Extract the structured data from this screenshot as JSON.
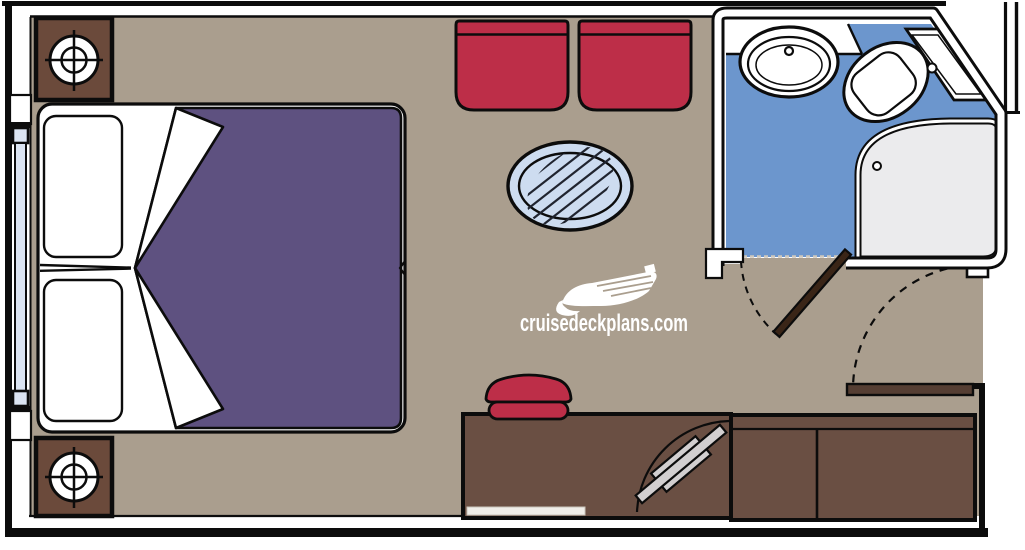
{
  "watermark": {
    "text": "cruisedeckplans.com",
    "logo_icon": "cruise-ship-icon"
  },
  "colors": {
    "line": "#0c0c0c",
    "floor": "#aa9e8e",
    "linen": "#ffffff",
    "duvet-purple": "#5e5180",
    "accent-red": "#bd2e48",
    "wood-dark": "#6b4a3b",
    "wood-desk": "#6a4f43",
    "bath-blue": "#6c96cd",
    "shower-gray": "#ebebed",
    "glass-blue": "#cddcf0",
    "stripe-dark": "#20242f",
    "window-blue": "#dbe4f2",
    "tv-gray": "#d2cfd0",
    "door-dark": "#3a2517",
    "door-entry": "#553e33",
    "watermark-white": "#ffffff",
    "desk-strip": "#f0eee9",
    "threshold": "#cfc8bd"
  },
  "furniture": [
    "bedside-table-with-reading-light x2",
    "twin-bed-with-purple-duvet x2",
    "pillow x2",
    "armchair x2",
    "oval-glass-table",
    "cabin-window",
    "bathroom-sink-with-counter",
    "toilet-with-tank",
    "corner-shower",
    "bathroom-door-with-swing-arc",
    "entry-door-with-swing-arc",
    "vanity-stool",
    "desk-with-swivel-tv",
    "cabinet x2"
  ]
}
